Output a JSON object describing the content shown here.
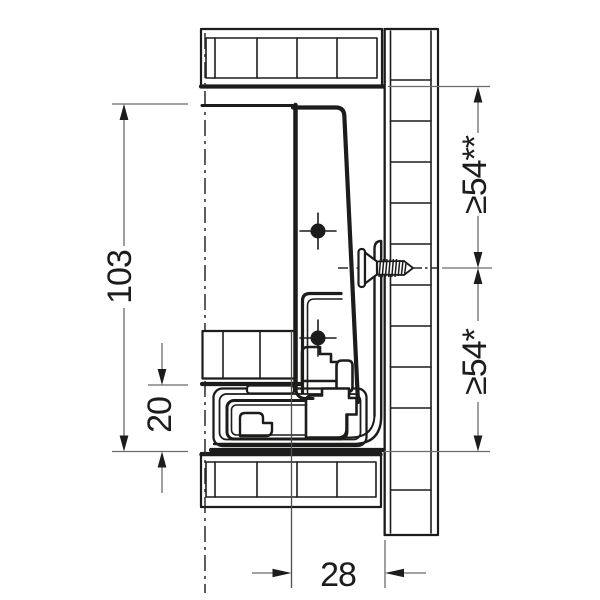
{
  "drawing": {
    "kind": "drawer-slide-cross-section",
    "background": "#ffffff",
    "outline_color": "#1c1c1b",
    "dimension_color": "#6b6b6b",
    "labels": {
      "vertical_103": "103",
      "vertical_20": "20",
      "horizontal_28": "28",
      "upper_clearance": "≥54**",
      "lower_clearance": "≥54*"
    }
  }
}
